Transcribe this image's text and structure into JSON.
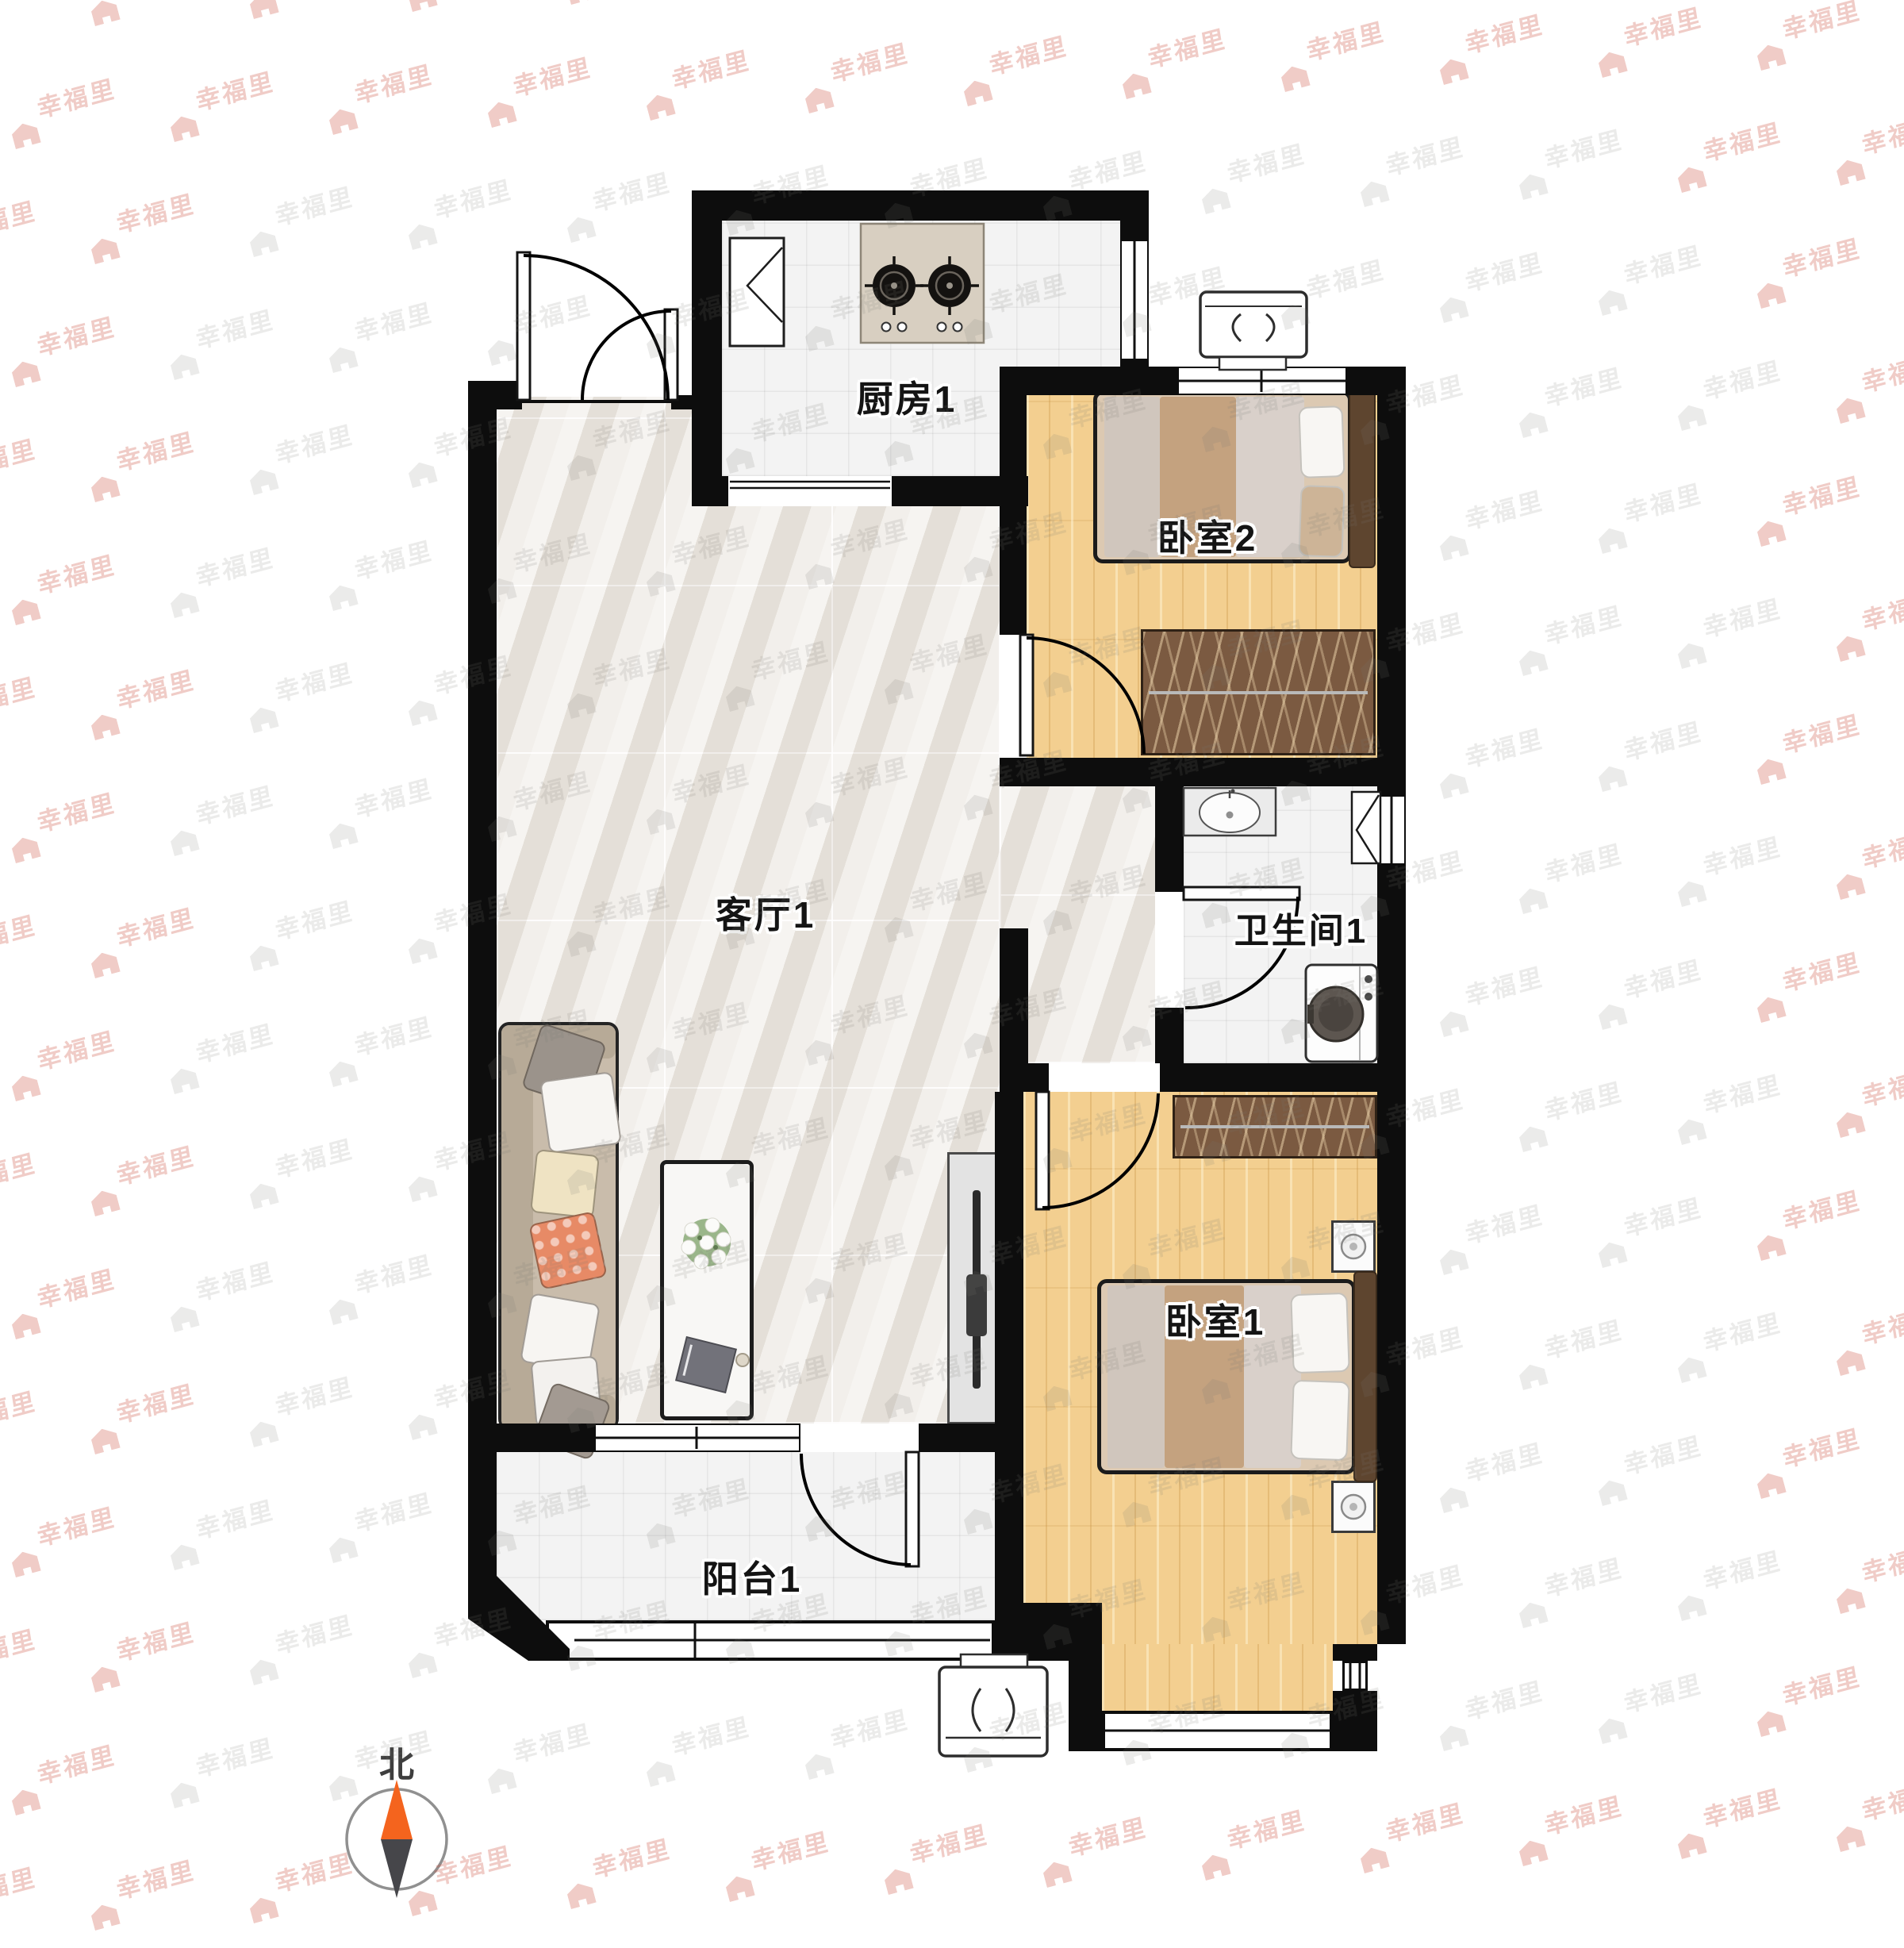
{
  "watermark": {
    "text": "幸福里",
    "gray_color": "rgba(124,119,112,0.15)",
    "red_color": "rgba(205,85,70,0.30)"
  },
  "rooms": {
    "kitchen": {
      "label": "厨房1"
    },
    "bedroom2": {
      "label": "卧室2"
    },
    "living": {
      "label": "客厅1"
    },
    "bathroom": {
      "label": "卫生间1"
    },
    "bedroom1": {
      "label": "卧室1"
    },
    "balcony": {
      "label": "阳台1"
    }
  },
  "compass": {
    "label": "北",
    "north_color": "#f4641e",
    "south_color": "#46464a"
  },
  "palette": {
    "wall": "#0d0d0d",
    "wood_floor": "#f3cf90",
    "marble_floor": "#ebe7e1",
    "tile_floor": "#f3f3f3",
    "wardrobe_brown": "#7b5a41",
    "bed_tan_band": "#c1a07f",
    "sofa_beige": "#c9bcab",
    "accent_orange_pillow": "#e78a66"
  },
  "icons": {
    "gas-stove-icon": "two black burners with cross ticks and four knobs",
    "kitchen-sink-icon": "white corner unit with fold lines",
    "bathroom-sink-icon": "oval basin on gray counter",
    "washing-machine-icon": "front-load drum washer",
    "air-conditioner-icon": "outdoor AC unit with brackets",
    "bedside-lamp-icon": "circle lamp on nightstand",
    "television-icon": "thin TV on media cabinet",
    "flower-decor-icon": "white flower bouquet on coffee table",
    "north-needle-icon": "orange/gray compass needle pointing up",
    "watermark-house-icon": "solid house glyph"
  }
}
